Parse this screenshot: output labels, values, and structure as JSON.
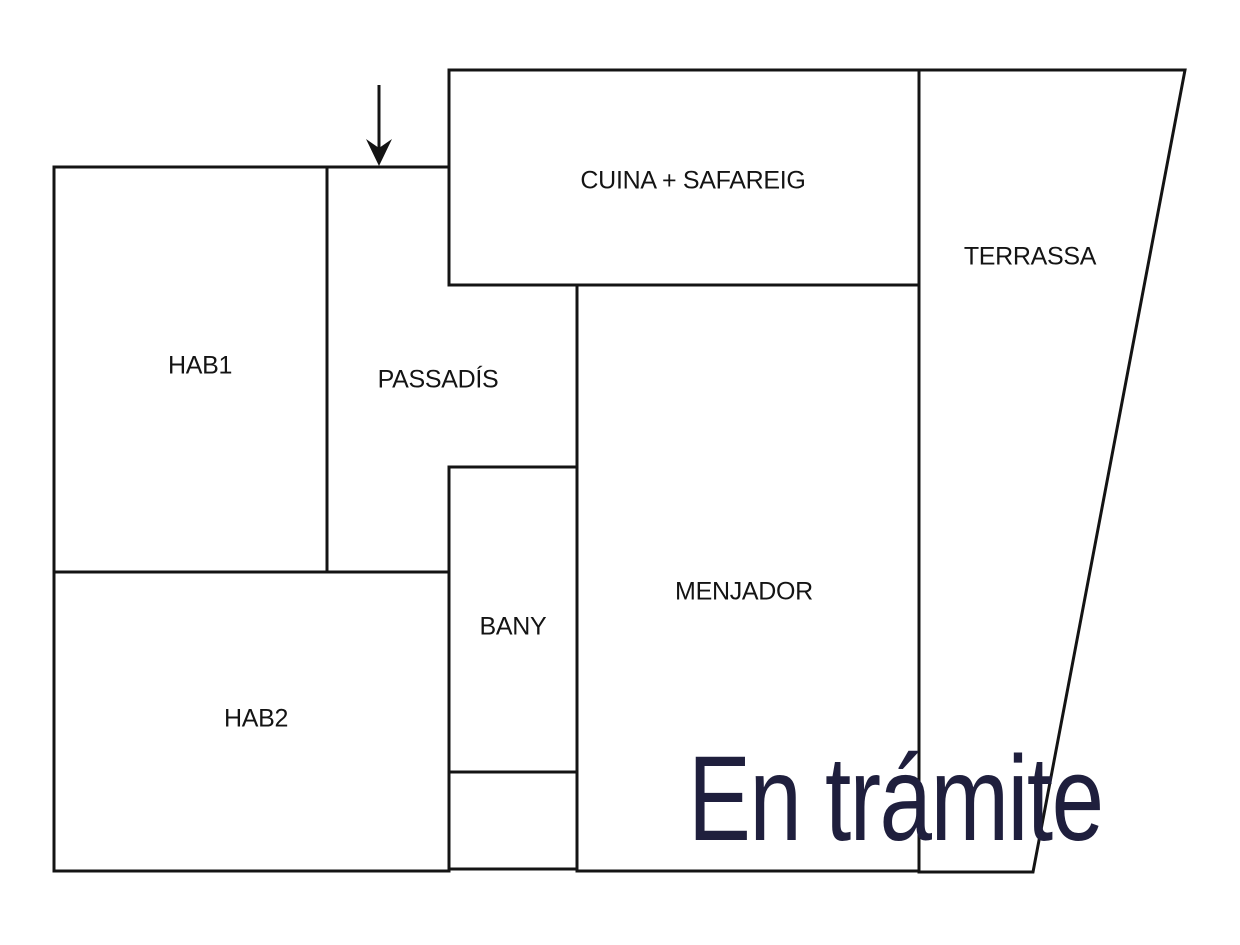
{
  "diagram": {
    "type": "floor-plan",
    "rooms": {
      "cuina": {
        "label": "CUINA + SAFAREIG"
      },
      "terrassa": {
        "label": "TERRASSA"
      },
      "hab1": {
        "label": "HAB1"
      },
      "passadis": {
        "label": "PASSADÍS"
      },
      "bany": {
        "label": "BANY"
      },
      "hab2": {
        "label": "HAB2"
      },
      "menjador": {
        "label": "MENJADOR"
      }
    },
    "icons": {
      "entry_arrow": "entry-arrow-down-icon"
    },
    "watermark": {
      "text": "En trámite"
    },
    "colors": {
      "wall": "#141414",
      "background": "#ffffff",
      "watermark": "#1f1f3d"
    }
  }
}
